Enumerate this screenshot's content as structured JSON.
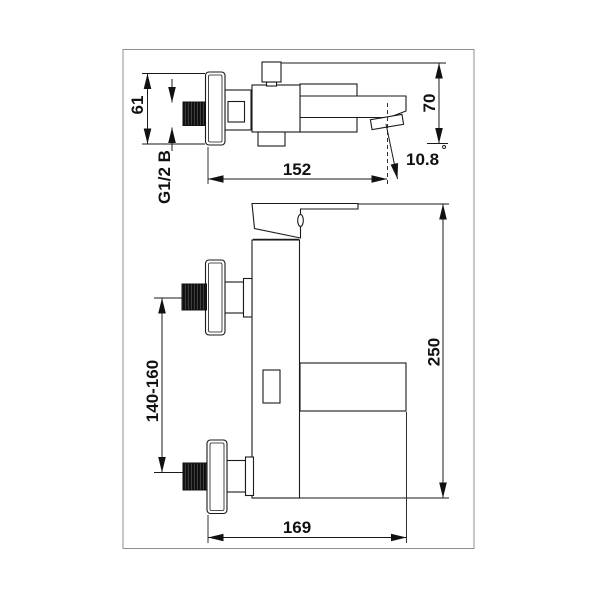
{
  "page": {
    "background": "#ffffff"
  },
  "drawing": {
    "frame_color": "#8f8f8f",
    "line_color": "#1a1a1a",
    "top_view": {
      "flange_diameter": "61",
      "thread_label": "G1/2 B",
      "spout_reach": "152",
      "height": "70",
      "spout_angle": "10.8",
      "degree": "°"
    },
    "front_view": {
      "inlet_spacing": "140-160",
      "overall_height": "250",
      "overall_depth": "169"
    }
  }
}
